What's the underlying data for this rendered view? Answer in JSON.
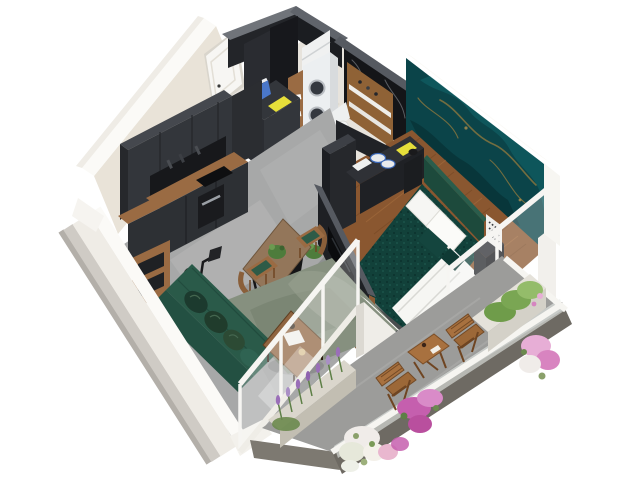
{
  "scene": {
    "kind": "isometric-3d-floor-plan-render",
    "background": "#ffffff",
    "rooms": [
      {
        "id": "entry-hall",
        "items": [
          "entry-door",
          "sideboard",
          "blue-jar",
          "yellow-towel"
        ]
      },
      {
        "id": "bathroom",
        "items": [
          "stacked-washer-dryer",
          "wood-vanity-shelves",
          "toilet",
          "round-basin"
        ]
      },
      {
        "id": "kitchen",
        "items": [
          "tall-dark-cabinets",
          "wood-counter",
          "cooktop",
          "oven",
          "open-wood-shelf"
        ]
      },
      {
        "id": "living-dining",
        "items": [
          "dining-table",
          "dining-chairs",
          "green-sofa",
          "patterned-pillows",
          "rug",
          "coffee-table",
          "floor-lamp",
          "tv-panel",
          "fireplace",
          "media-console",
          "plant"
        ]
      },
      {
        "id": "bedroom",
        "items": [
          "double-bed",
          "green-headboard",
          "white-pillows",
          "teal-marble-accent-wall",
          "nightstands",
          "grid-lamp",
          "dresser-console",
          "striped-boxes",
          "bench",
          "wood-floor"
        ]
      },
      {
        "id": "balcony",
        "items": [
          "bistro-table",
          "folding-chairs",
          "lavender-planter",
          "flower-boxes",
          "green-planter",
          "glass-parapet",
          "privacy-wall"
        ]
      }
    ]
  },
  "palette": {
    "wallWhiteTop": "#fbfaf7",
    "wallWhiteFace": "#efece6",
    "wallCream": "#e9e3d8",
    "wallDark": "#232529",
    "wallMarbleDark": "#141518",
    "wallCapGray": "#70747a",
    "slabGray": "#cfcbc5",
    "slabDark": "#6e6a63",
    "tealWall": "#0b4449",
    "tealBlotch": "#15787d",
    "tealDeep": "#06282c",
    "goldVein": "#b9893a",
    "floorConcrete": "#a7a8a8",
    "floorWood": "#8a5730",
    "floorTile": "#e7e3dc",
    "balconyFloor": "#9c9c9a",
    "cabinetDark": "#33363b",
    "cabinetDeep": "#26282c",
    "counterWood": "#9a6b43",
    "applianceWhite": "#eceff1",
    "sofaGreen": "#2a5a49",
    "sofaBack": "#235042",
    "rugGray": "#86907f",
    "duvetTeal": "#12413a",
    "headboardGreen": "#1d4a3c",
    "pillowWhite": "#f6f6f3",
    "tvBlack": "#0b0c0e",
    "fireOrange": "#e07b2a",
    "fireCore": "#f5a623",
    "furnitureWood": "#a8713f",
    "plantGreen": "#4e7c3c",
    "bushGreen": "#6f9c4a",
    "lavenderPurple": "#9a6fb8",
    "flowerMagenta": "#c55fae",
    "flowerPink": "#e7aed6",
    "flowerWhite": "#f0ece9",
    "accentYellow": "#e6df3a",
    "accentBlue": "#4a77c9",
    "parapetWhite": "#f6f5f1",
    "doorWhite": "#f7f6f3"
  }
}
